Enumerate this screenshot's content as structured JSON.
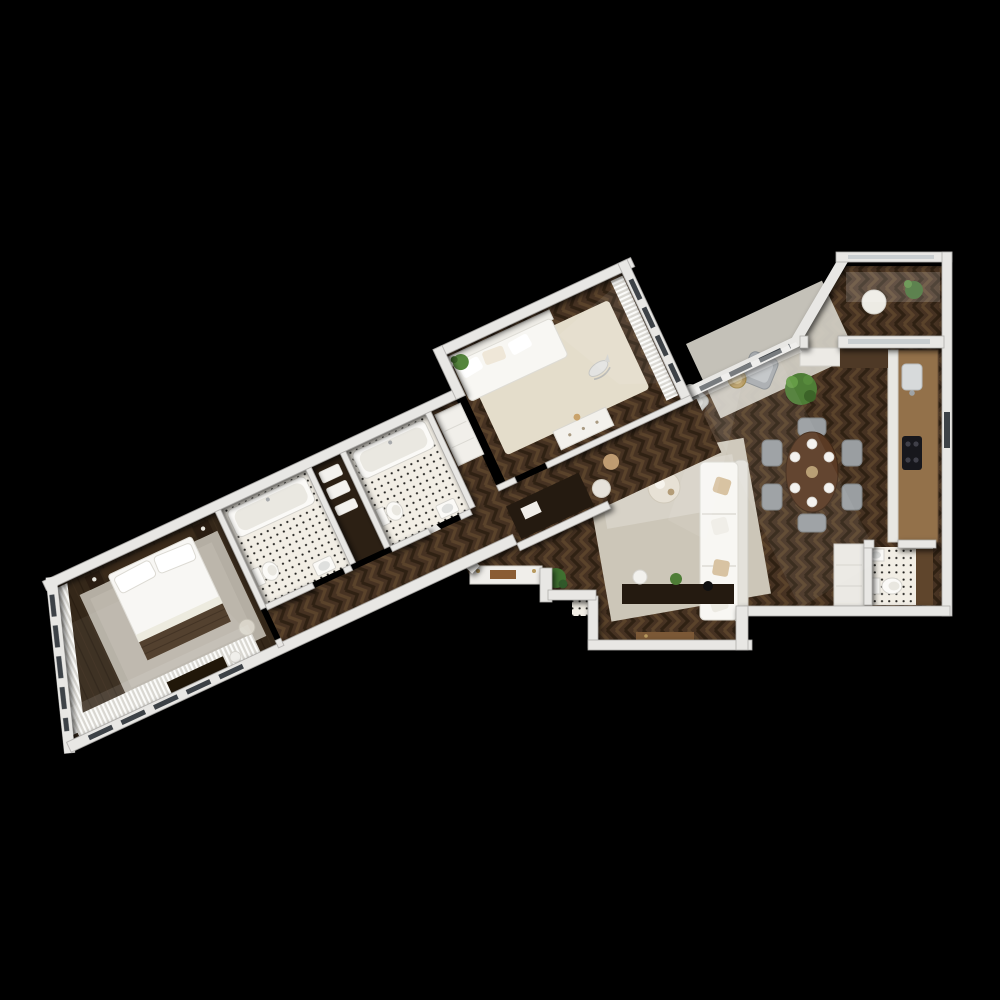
{
  "scene": {
    "description": "3D top-down architectural render of a two-bedroom apartment floor plan, rotated diagonally on a black background",
    "view": "top-down 3D render",
    "background": "#000000"
  },
  "palette": {
    "background": "#000000",
    "wall": "#e8e7e4",
    "wall_edge": "#aeadaa",
    "herr_base": "#463222",
    "herr_light": "#5a432b",
    "herr_dark": "#2f2113",
    "plank_base": "#342719",
    "tile": "#f2eee5",
    "tile_dot": "#23221f",
    "rug_bedroom": "#b4aea3",
    "rug_kids": "#e4ddcb",
    "rug_living": "#ccc6b8",
    "rug_lounge": "#d5d1c8",
    "sofa": "#f8f7f3",
    "bed": "#f8f7f4",
    "wood_walnut": "#5a3a24",
    "wood_oak": "#93714a",
    "wood_dark": "#241a10",
    "wood_vanity": "#5f452c",
    "chair_gray": "#9a9ea1",
    "plant": "#4e7d36",
    "plant_dark": "#3f6b2e",
    "brass": "#b89a5e",
    "curtain": "#fcfcfa",
    "appliance_black": "#17171c",
    "pillow_beige": "#d8c3a2",
    "window_glass": "#3d4247"
  },
  "apartment": {
    "wings": [
      {
        "id": "bedroom-wing",
        "rotation_deg": -25
      },
      {
        "id": "living-wing",
        "rotation_deg": 0
      }
    ],
    "rooms": [
      {
        "id": "master-bedroom",
        "label": "Master bedroom",
        "furniture": [
          "double bed",
          "dark headboard",
          "walnut bed-end throw",
          "two nightstands",
          "chest of drawers",
          "sphere floor lamp",
          "pouf",
          "stone-grey area rug",
          "sheer curtains along window wall"
        ]
      },
      {
        "id": "bathroom-1",
        "label": "Bathroom 1",
        "furniture": [
          "bathtub",
          "toilet",
          "washbasin",
          "penny-tile floor"
        ]
      },
      {
        "id": "linen-niche",
        "label": "Linen niche",
        "furniture": [
          "shelves with towels"
        ]
      },
      {
        "id": "bathroom-2",
        "label": "Bathroom 2",
        "furniture": [
          "bathtub",
          "toilet",
          "washbasin",
          "penny-tile floor"
        ]
      },
      {
        "id": "hallway",
        "label": "Hallway",
        "furniture": [
          "herringbone oak floor",
          "writing desk",
          "pouf",
          "linen cabinet",
          "pampas grass"
        ]
      },
      {
        "id": "kids-bedroom",
        "label": "Kids bedroom",
        "furniture": [
          "daybed with pillows",
          "cream rug",
          "rocking whale toy",
          "white dresser",
          "potted plant",
          "sheer curtains"
        ]
      },
      {
        "id": "living-room",
        "label": "Living room",
        "furniture": [
          "white corner sofa",
          "throw pillows",
          "round coffee table",
          "large area rug",
          "dark media console",
          "decor sphere",
          "fern"
        ]
      },
      {
        "id": "lounge-corner",
        "label": "Lounge corner",
        "furniture": [
          "grey armchair",
          "light accent chair",
          "brass side table",
          "potted palm",
          "small rug"
        ]
      },
      {
        "id": "dining-area",
        "label": "Dining area",
        "furniture": [
          "oval walnut table",
          "six grey chairs",
          "place settings"
        ]
      },
      {
        "id": "kitchen",
        "label": "Kitchen",
        "furniture": [
          "oak counter run",
          "black cooktop",
          "steel sink",
          "tall cabinets"
        ]
      },
      {
        "id": "loggia",
        "label": "Loggia",
        "furniture": [
          "round table",
          "potted plant"
        ]
      },
      {
        "id": "wc",
        "label": "Guest WC",
        "furniture": [
          "toilet",
          "washbasin",
          "wood vanity panel",
          "penny-tile floor"
        ]
      },
      {
        "id": "entry",
        "label": "Entry",
        "furniture": [
          "shoe bench with tray",
          "front door",
          "doormat",
          "fern"
        ]
      }
    ]
  }
}
